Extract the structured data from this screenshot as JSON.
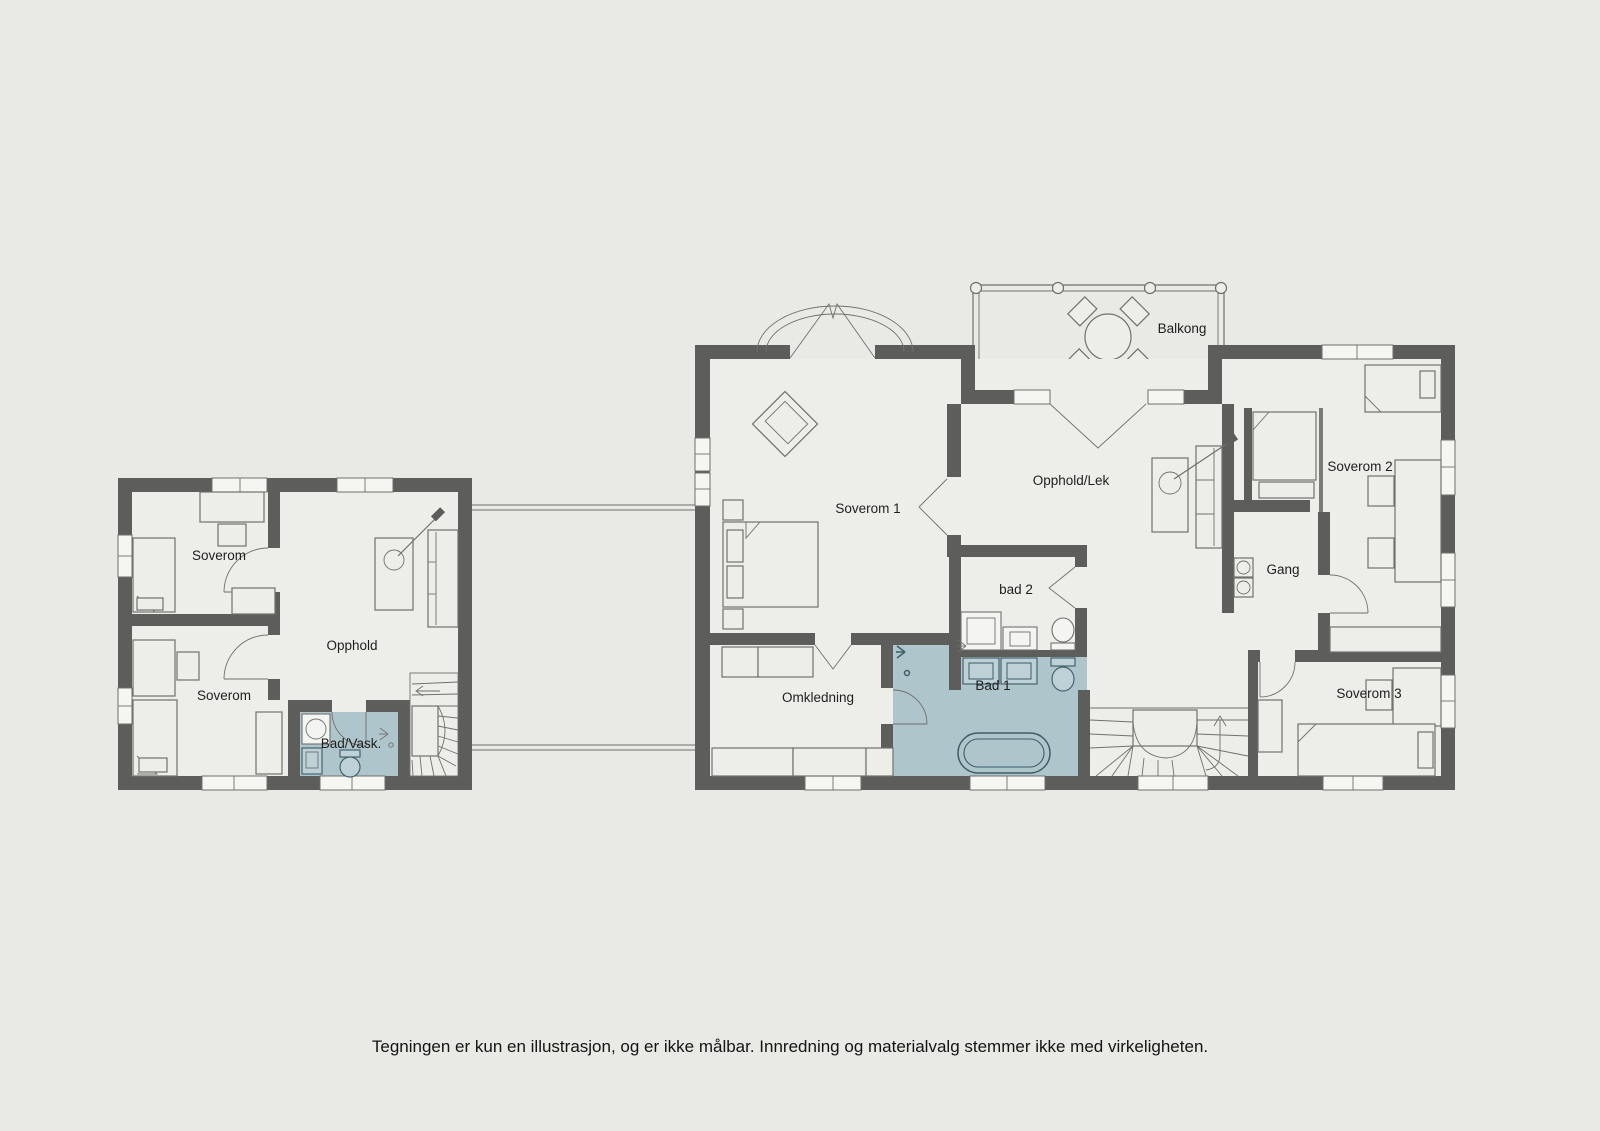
{
  "colors": {
    "background": "#e9eae5",
    "floor": "#edeeea",
    "wall": "#5d5d5b",
    "bath": "#aec5cb",
    "bathfix": "#bdd1d6",
    "window": "#f5f5f2",
    "line": "#70706c",
    "text": "#1e1e1e"
  },
  "rooms": {
    "left_soverom_upper": "Soverom",
    "left_soverom_lower": "Soverom",
    "left_opphold": "Opphold",
    "left_bad_vask": "Bad/Vask.",
    "soverom_1": "Soverom 1",
    "opphold_lek": "Opphold/Lek",
    "balkong": "Balkong",
    "bad_2": "bad 2",
    "bad_1": "Bad 1",
    "omkledning": "Omkledning",
    "gang": "Gang",
    "soverom_2": "Soverom 2",
    "soverom_3": "Soverom 3"
  },
  "footer": {
    "disclaimer": "Tegningen er kun en illustrasjon, og er ikke målbar. Innredning og materialvalg stemmer ikke med virkeligheten."
  }
}
